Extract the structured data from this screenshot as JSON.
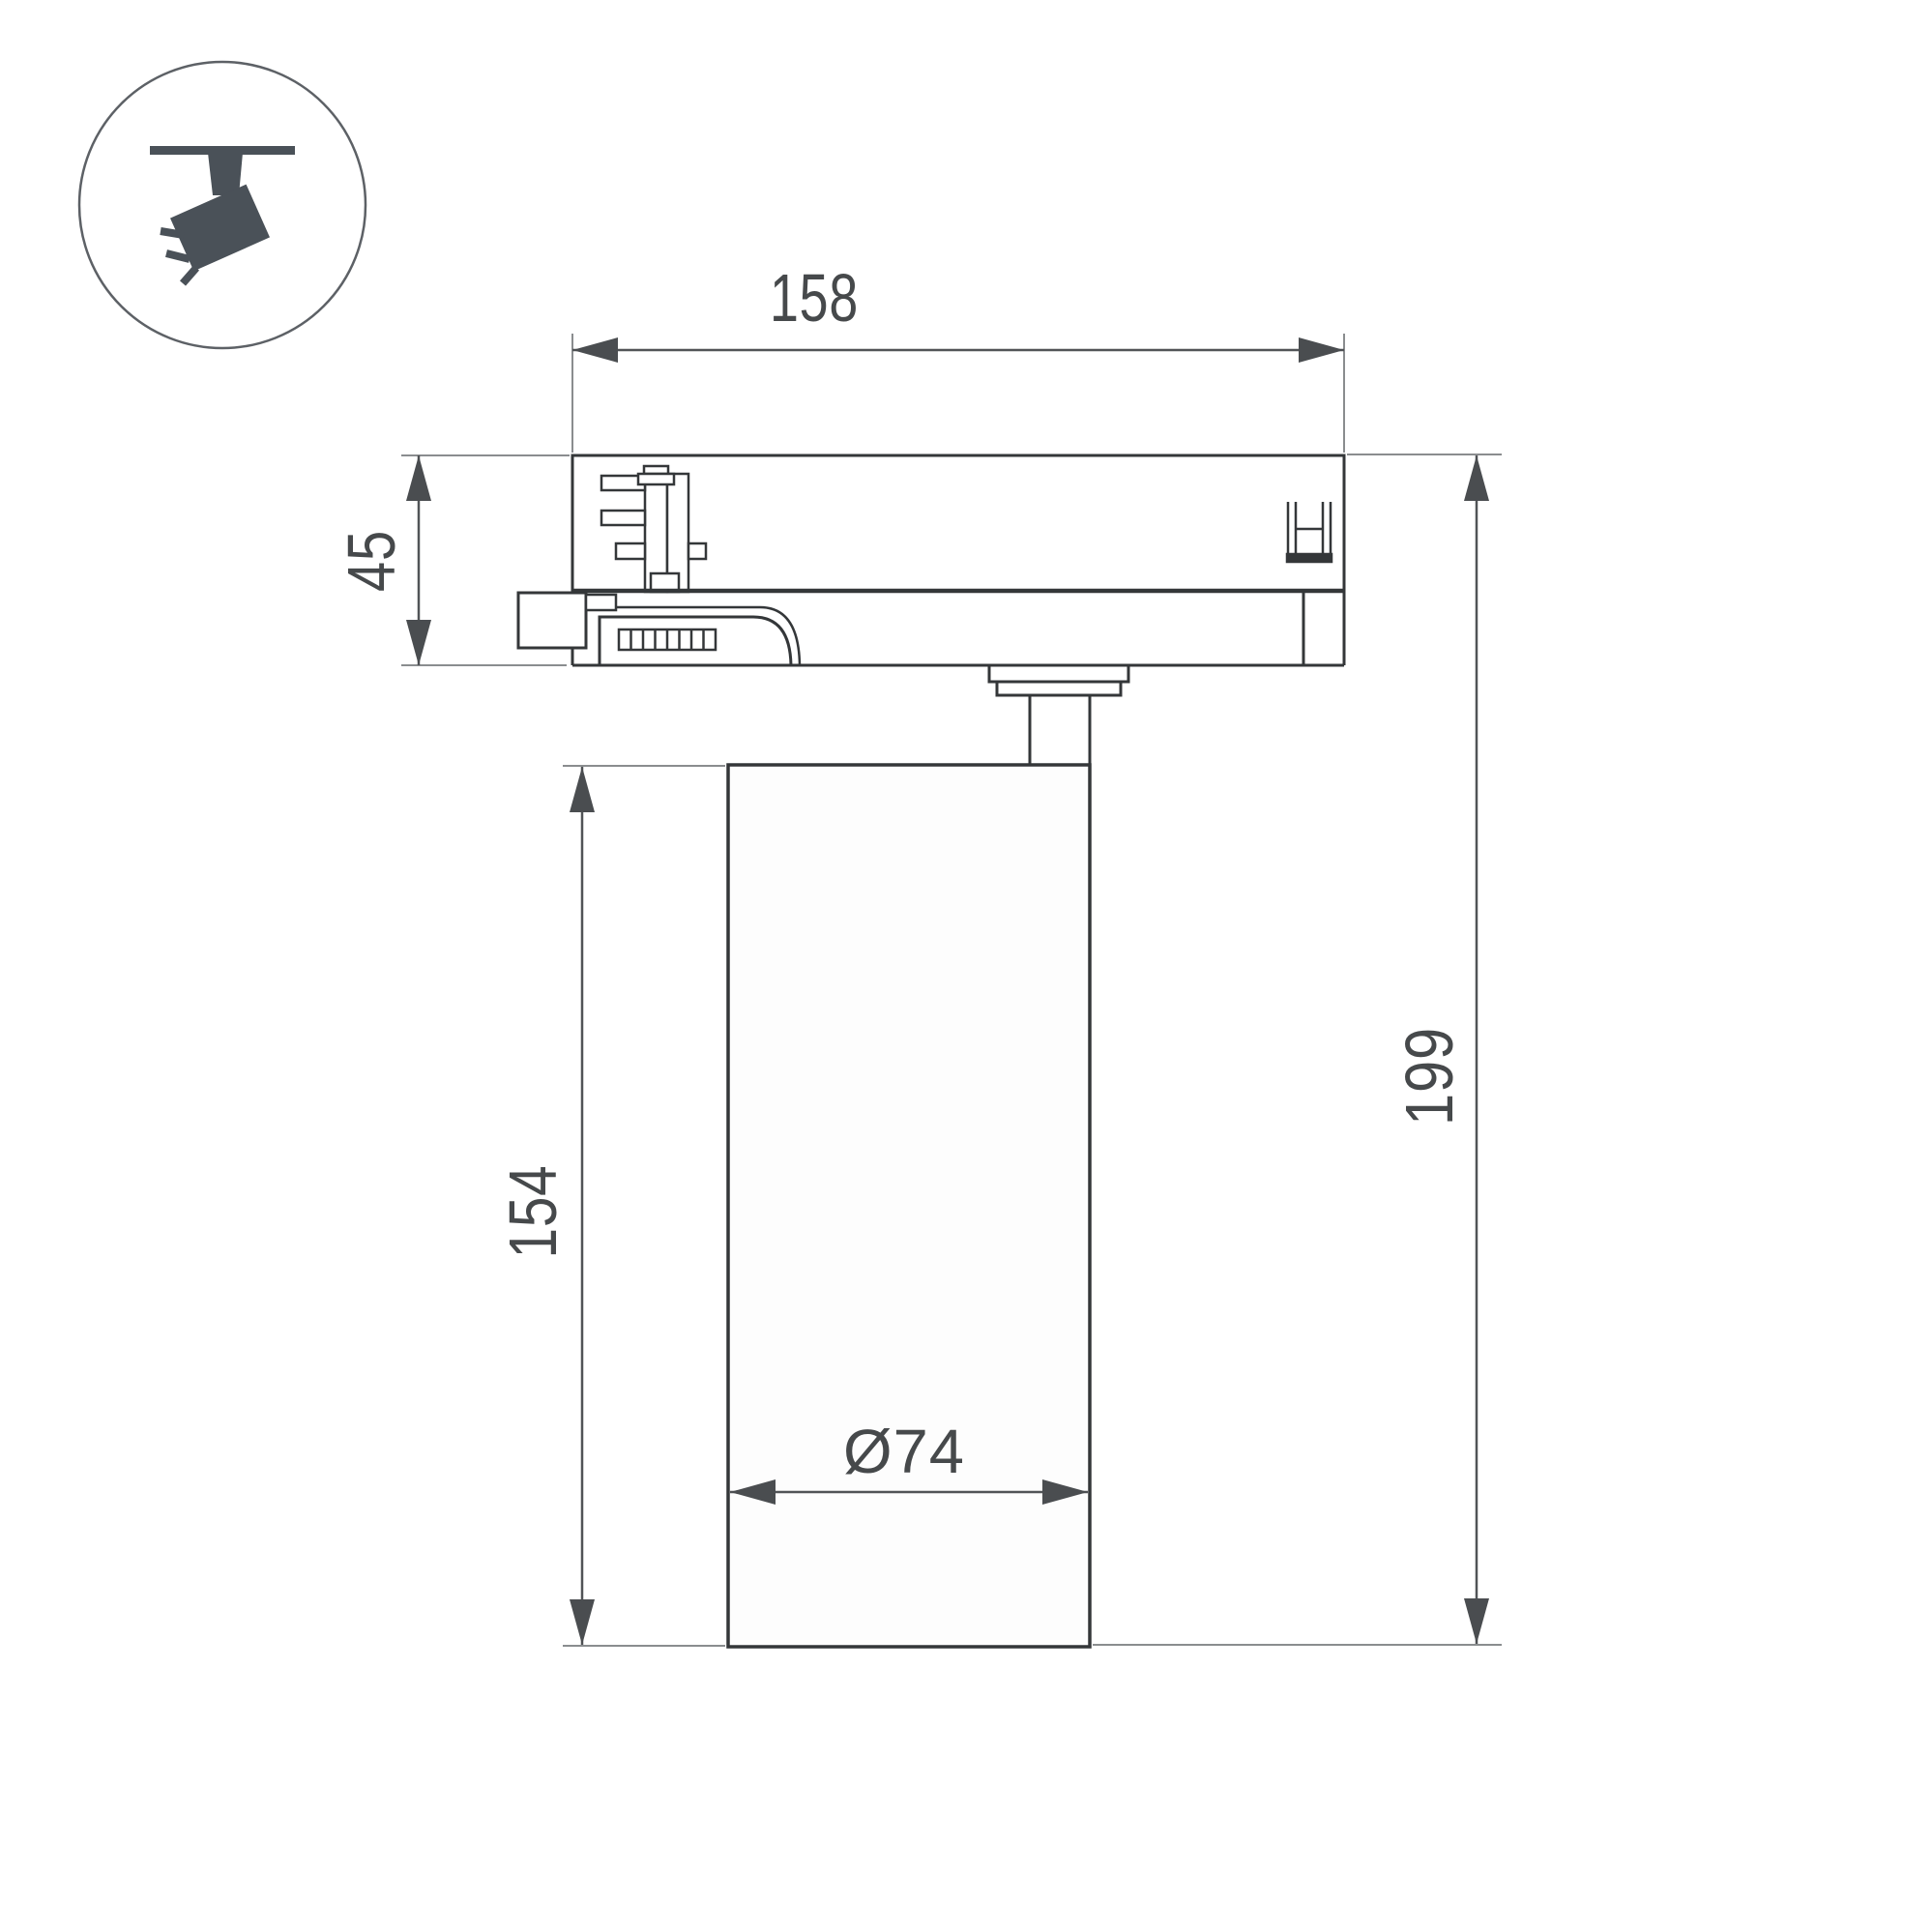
{
  "legend_icon": {
    "name": "track-spotlight-icon",
    "description": "circled pictogram of a spotlight hanging from a ceiling track, tilted, emitting three light rays"
  },
  "drawing": {
    "type": "technical-dimension-drawing",
    "object": "track light fixture side view",
    "dimensions": {
      "adapter_width": {
        "value": "158",
        "orientation": "horizontal"
      },
      "adapter_height": {
        "value": "45",
        "orientation": "vertical"
      },
      "body_height": {
        "value": "154",
        "orientation": "vertical"
      },
      "total_height": {
        "value": "199",
        "orientation": "vertical"
      },
      "body_diameter": {
        "value": "Ø74",
        "orientation": "horizontal"
      }
    }
  },
  "colors": {
    "background": "#ffffff",
    "outline": "#343739",
    "dimension_line": "#515457",
    "extension_line": "#8a8d8f",
    "label_text": "#46494b",
    "icon_fill": "#4a5158",
    "icon_circle_stroke": "#5d6166"
  }
}
